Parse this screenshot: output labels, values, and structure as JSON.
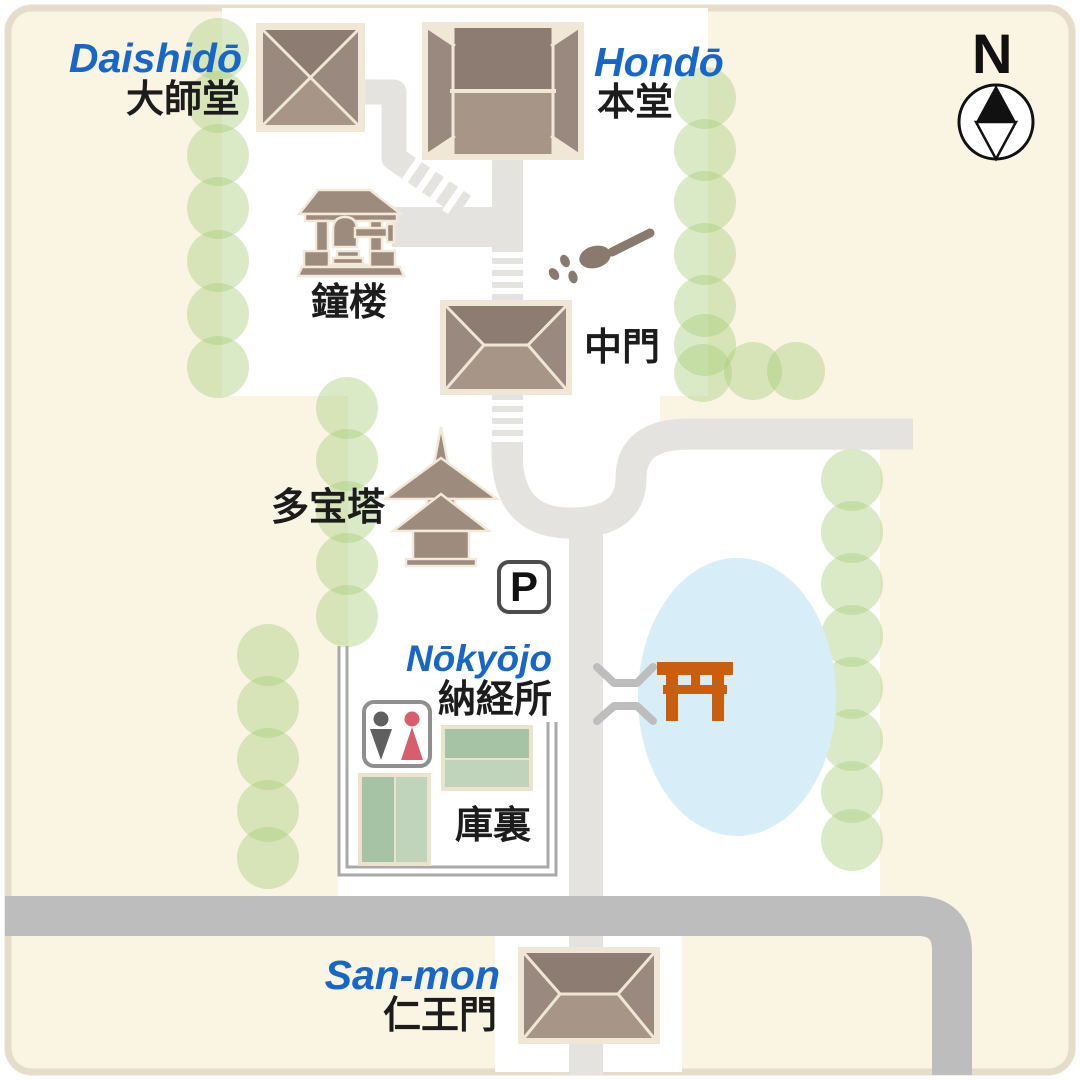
{
  "map": {
    "compass": {
      "label": "N"
    },
    "parking": {
      "label": "P"
    },
    "locations": {
      "daishido": {
        "romaji": "Daishidō",
        "kanji": "大師堂"
      },
      "hondo": {
        "romaji": "Hondō",
        "kanji": "本堂"
      },
      "shoro": {
        "kanji": "鐘楼"
      },
      "chumon": {
        "kanji": "中門"
      },
      "tahoto": {
        "kanji": "多宝塔"
      },
      "nokyojo": {
        "romaji": "Nōkyōjo",
        "kanji": "納経所"
      },
      "kuri": {
        "kanji": "庫裏"
      },
      "sanmon": {
        "romaji": "San-mon",
        "kanji": "仁王門"
      }
    },
    "icons": {
      "compass_north": "north-compass-needle",
      "parking": "parking-sign",
      "restroom": "male-female-restroom-pictogram",
      "water_ladle": "purification-ladle-with-drops",
      "torii": "torii-gate",
      "bridge": "bridge-map-symbol",
      "bell_tower": "bell-tower-side-view",
      "pagoda": "two-storey-pagoda-side-view"
    },
    "colors": {
      "background": "#faf4e3",
      "frame_border": "#e5ddca",
      "precinct_white": "#ffffff",
      "path_gray": "#e4e3e0",
      "road_gray": "#bdbdbd",
      "tree_green": "#a8cd79",
      "pond_blue": "#d7edf8",
      "torii_orange": "#c95e0f",
      "roof_dark": "#8d7c72",
      "roof_mid": "#9a897e",
      "roof_light": "#a79688",
      "roof_outline": "#f0e7d7",
      "icon_brown": "#9d8b7d",
      "ladle_brown": "#8a7a6e",
      "green_building_dark": "#a7c3a5",
      "green_building_light": "#bfd4ba",
      "wall_gray": "#a9a9a9",
      "label_blue": "#1767c9",
      "label_black": "#1c1c1c",
      "restroom_male": "#5f5f5f",
      "restroom_female": "#d75f6d"
    }
  }
}
